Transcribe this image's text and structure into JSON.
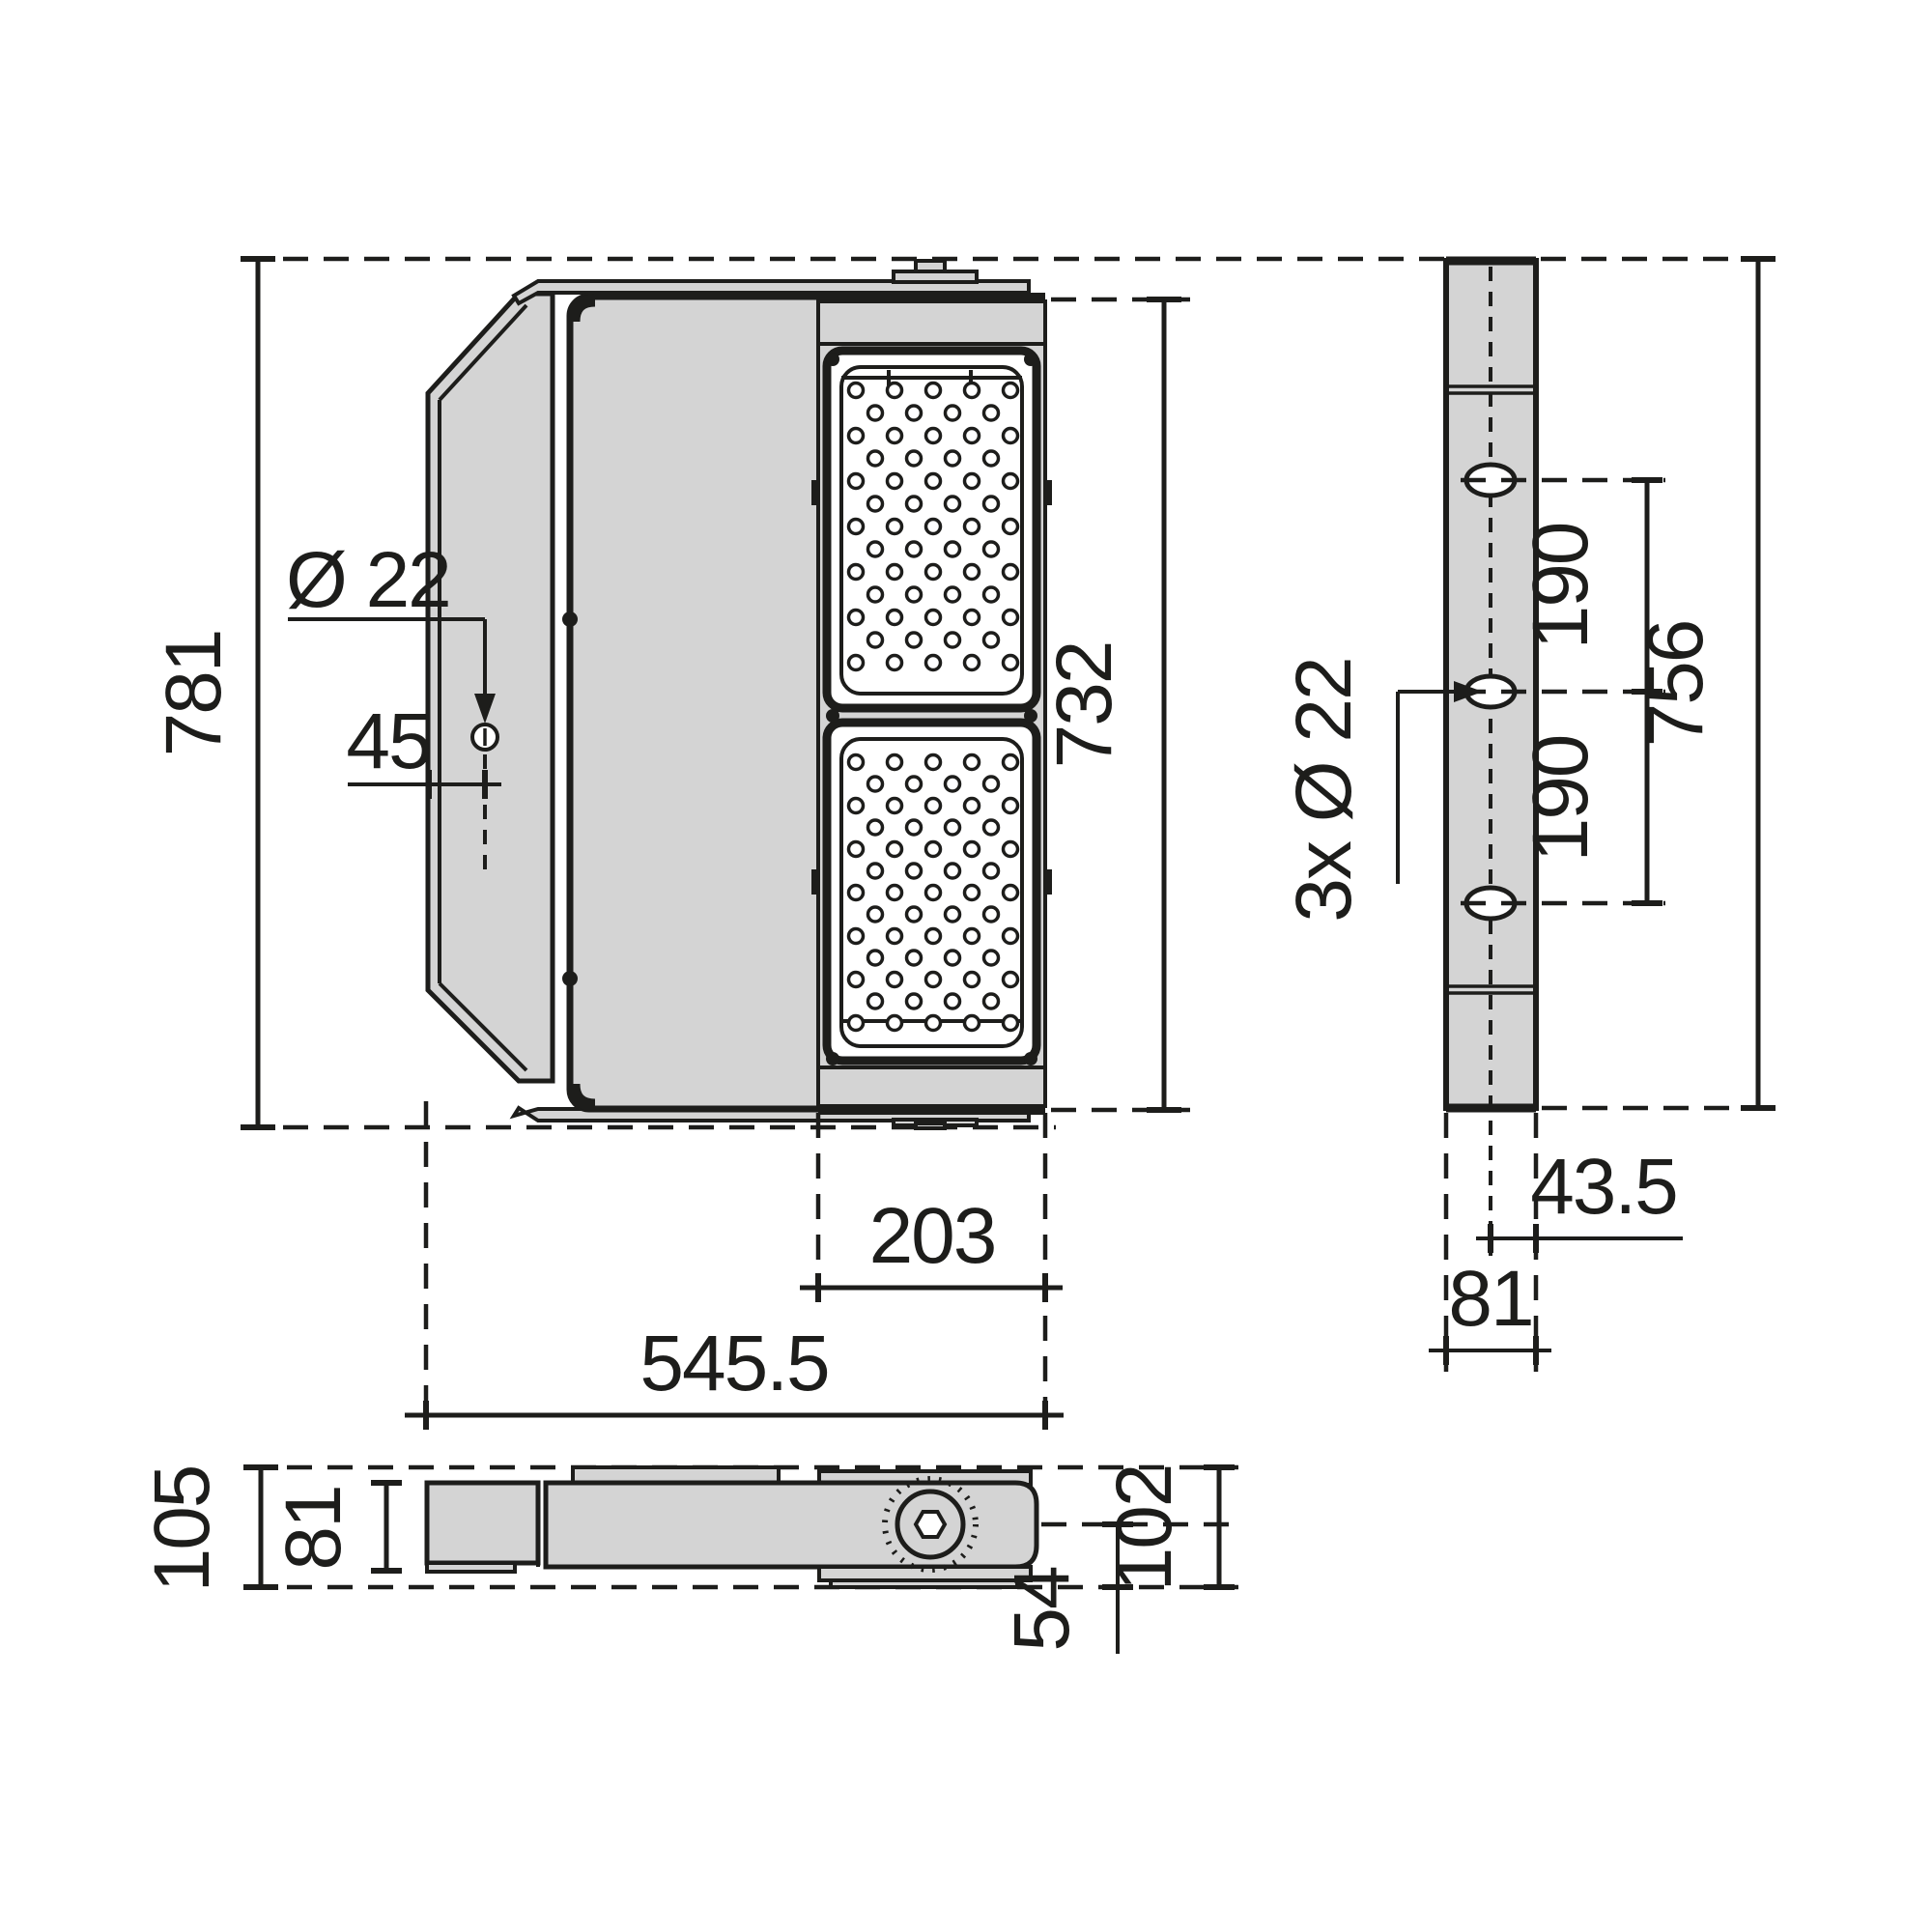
{
  "drawing": {
    "kind": "luminaire-dimension-drawing",
    "unit": "mm",
    "colors": {
      "line": "#1d1d1b",
      "body_fill": "#d4d4d4",
      "background": "#ffffff"
    }
  },
  "labels": {
    "front": {
      "height": "781",
      "hole_dia": "Ø 22",
      "hole_offset": "45",
      "module_height": "732",
      "module_width": "203",
      "width": "545.5"
    },
    "side": {
      "spacing_top": "190",
      "spacing_bottom": "190",
      "height": "756",
      "holes_note": "3x Ø 22",
      "center_offset": "43.5",
      "depth": "81"
    },
    "top": {
      "overall_depth": "105",
      "body_depth": "81",
      "pivot_offset": "54",
      "pivot_height": "102"
    }
  }
}
